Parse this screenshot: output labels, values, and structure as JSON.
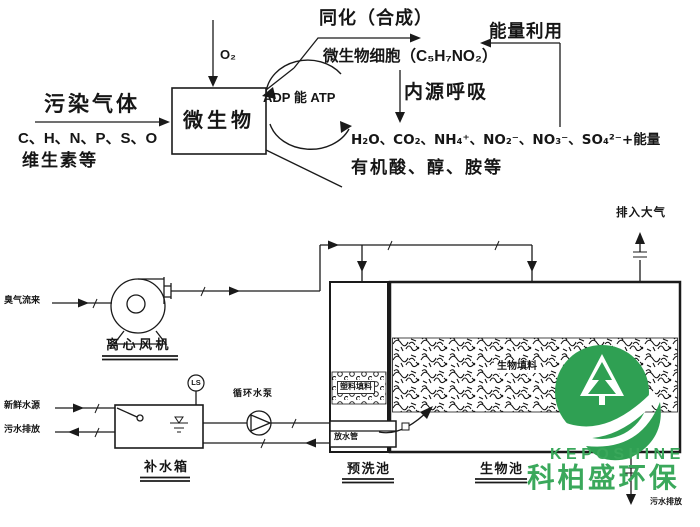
{
  "colors": {
    "line": "#1a1a1a",
    "logo_green": "#2fa053",
    "logo_text_green": "#3aa85b"
  },
  "top_flow": {
    "pollutant_gas": "污染气体",
    "elements_line": "C、H、N、P、S、O",
    "vitamins_line": "维生素等",
    "microbe_box": "微生物",
    "oxygen": "O₂",
    "adp_energy_atp": "ADP 能 ATP",
    "assimilation": "同化（合成）",
    "microbial_cell": "微生物细胞（C₅H₇NO₂）",
    "energy_use": "能量利用",
    "endogenous_respiration": "内源呼吸",
    "products_line1": "H₂O、CO₂、NH₄⁺、NO₂⁻、NO₃⁻、SO₄²⁻+能量",
    "products_line2": "有机酸、醇、胺等"
  },
  "equipment_flow": {
    "odor_inlet": "臭气流来",
    "fan_label": "离心风机",
    "to_atmosphere": "排入大气",
    "fresh_water": "新鲜水源",
    "waste_water_left": "污水排放",
    "water_tank": "补水箱",
    "level_switch": "LS",
    "pump_label": "循环水泵",
    "prewash_pool": "预洗池",
    "bio_pool": "生物池",
    "plastic_packing": "塑料填料",
    "bio_packing": "生物填料",
    "drain_pipe_box": "放水管",
    "waste_water_right": "污水排放"
  },
  "logo": {
    "latin": "KEPOSHINE",
    "chinese": "科柏盛环保"
  }
}
